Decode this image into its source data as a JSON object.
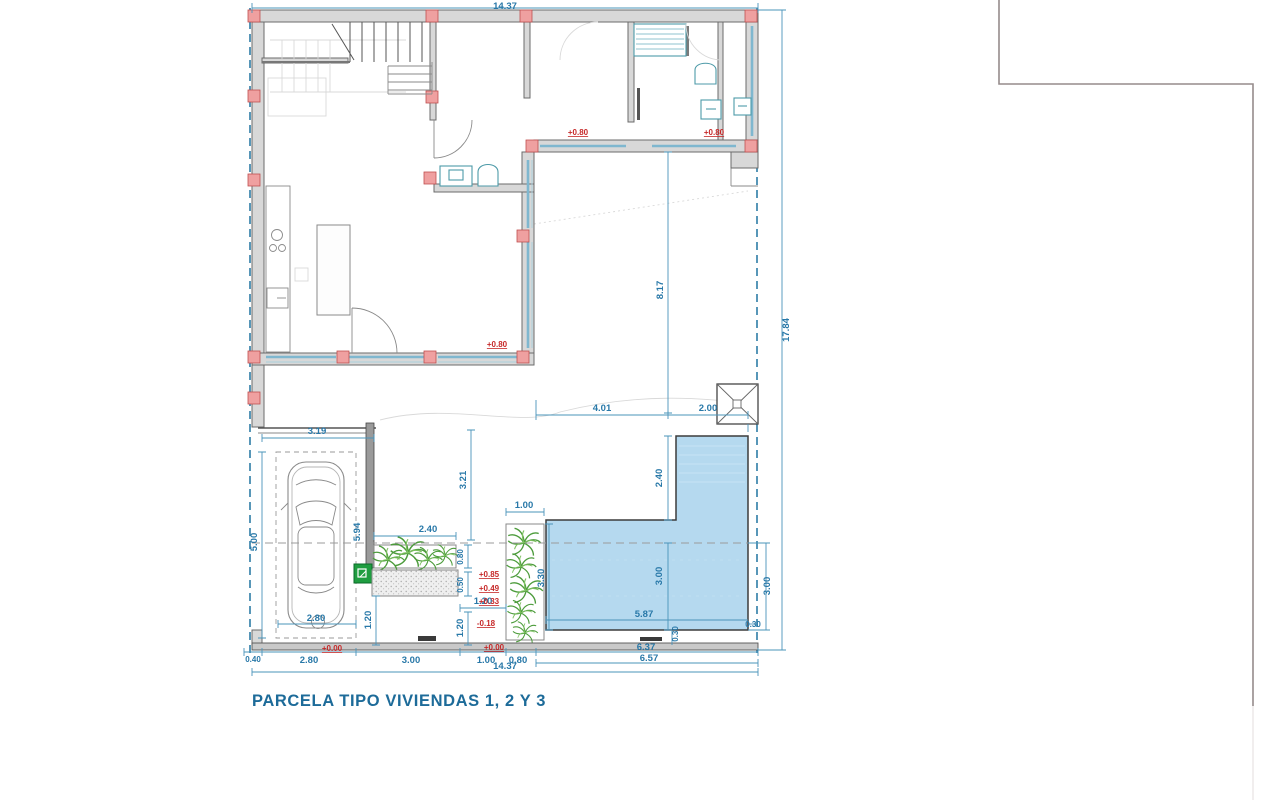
{
  "title": "PARCELA TIPO VIVIENDAS 1, 2 Y 3",
  "colors": {
    "dimension_blue": "#2878a8",
    "level_red": "#c62828",
    "wall_gray": "#d8d8d8",
    "column_pink": "#efa0a0",
    "pool_blue": "#b5d9ef",
    "boundary_teal": "#2e7da6",
    "plant_green": "#4d9c3c",
    "title_blue": "#1d6b99"
  },
  "dims": {
    "top_width": "14.37",
    "right_height": "17.84",
    "patio_depth": "8.17",
    "patio_width": "4.01",
    "pool_arm_top": "2.00",
    "pool_arm_side": "2.40",
    "pool_inner_depth": "3.00",
    "pool_right_depth": "3.00",
    "pool_left_depth": "3.30",
    "pool_length": "5.87",
    "pool_edge_right": "0.30",
    "pool_edge_bottom": "0.30",
    "garage_width": "3.19",
    "garage_depth": "5.00",
    "garage_wall": "5.94",
    "car_bay_width": "2.80",
    "court_depth": "3.21",
    "planter_width": "2.40",
    "planter_strip_width": "1.00",
    "planter_depth": "0.80",
    "step_depth": "0.50",
    "step_width": "1.20",
    "walk_left": "1.20",
    "walk_right": "1.20",
    "bottom_offset": "0.40",
    "bottom_garage": "2.80",
    "bottom_court": "3.00",
    "bottom_walk": "1.00",
    "bottom_strip": "0.80",
    "bottom_pool_a": "6.37",
    "bottom_pool_b": "6.57",
    "bottom_total": "14.37"
  },
  "levels": {
    "porch_left": "+0.80",
    "porch_right": "+0.80",
    "window_sill": "+0.80",
    "terrace_a": "+0.85",
    "terrace_b": "+0.49",
    "terrace_c": "+0.33",
    "deck": "-0.18",
    "ground_garage": "+0.00",
    "ground_walk": "+0.00"
  }
}
